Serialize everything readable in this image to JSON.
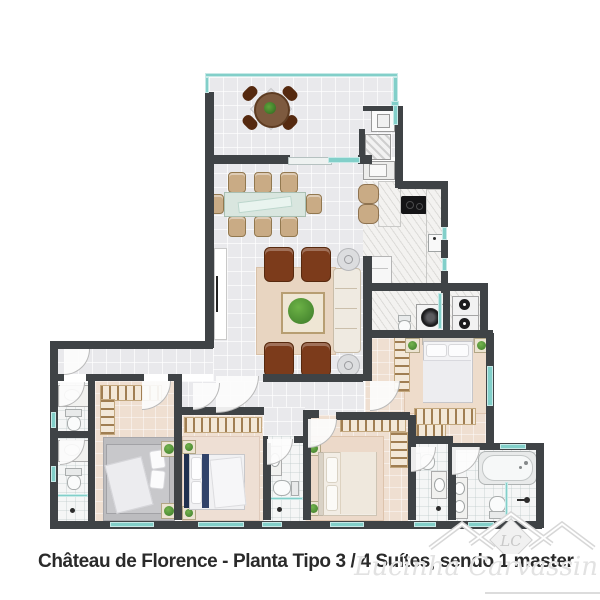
{
  "caption": {
    "text": "Château de Florence - Planta Tipo 3 / 4 Suítes, sendo 1 master"
  },
  "watermark": {
    "initials": "LC",
    "signature": "Lucinha Carvassin"
  },
  "colors": {
    "wall": "#3f4346",
    "teal": "#82cfc9",
    "floor": "#e9e9ec",
    "beige": "#efdfd1",
    "bath": "#f5f6f6",
    "marble": "#f3f2f0",
    "rug-beige": "#e8d5c1",
    "rug-gray": "#bcbcbf",
    "armchair": "#7c3b1b",
    "chair-tan": "#c9ab85",
    "plant": "#3c7a29",
    "caption-text": "#2a2a2a",
    "watermark-gray": "#d7d7d7"
  }
}
